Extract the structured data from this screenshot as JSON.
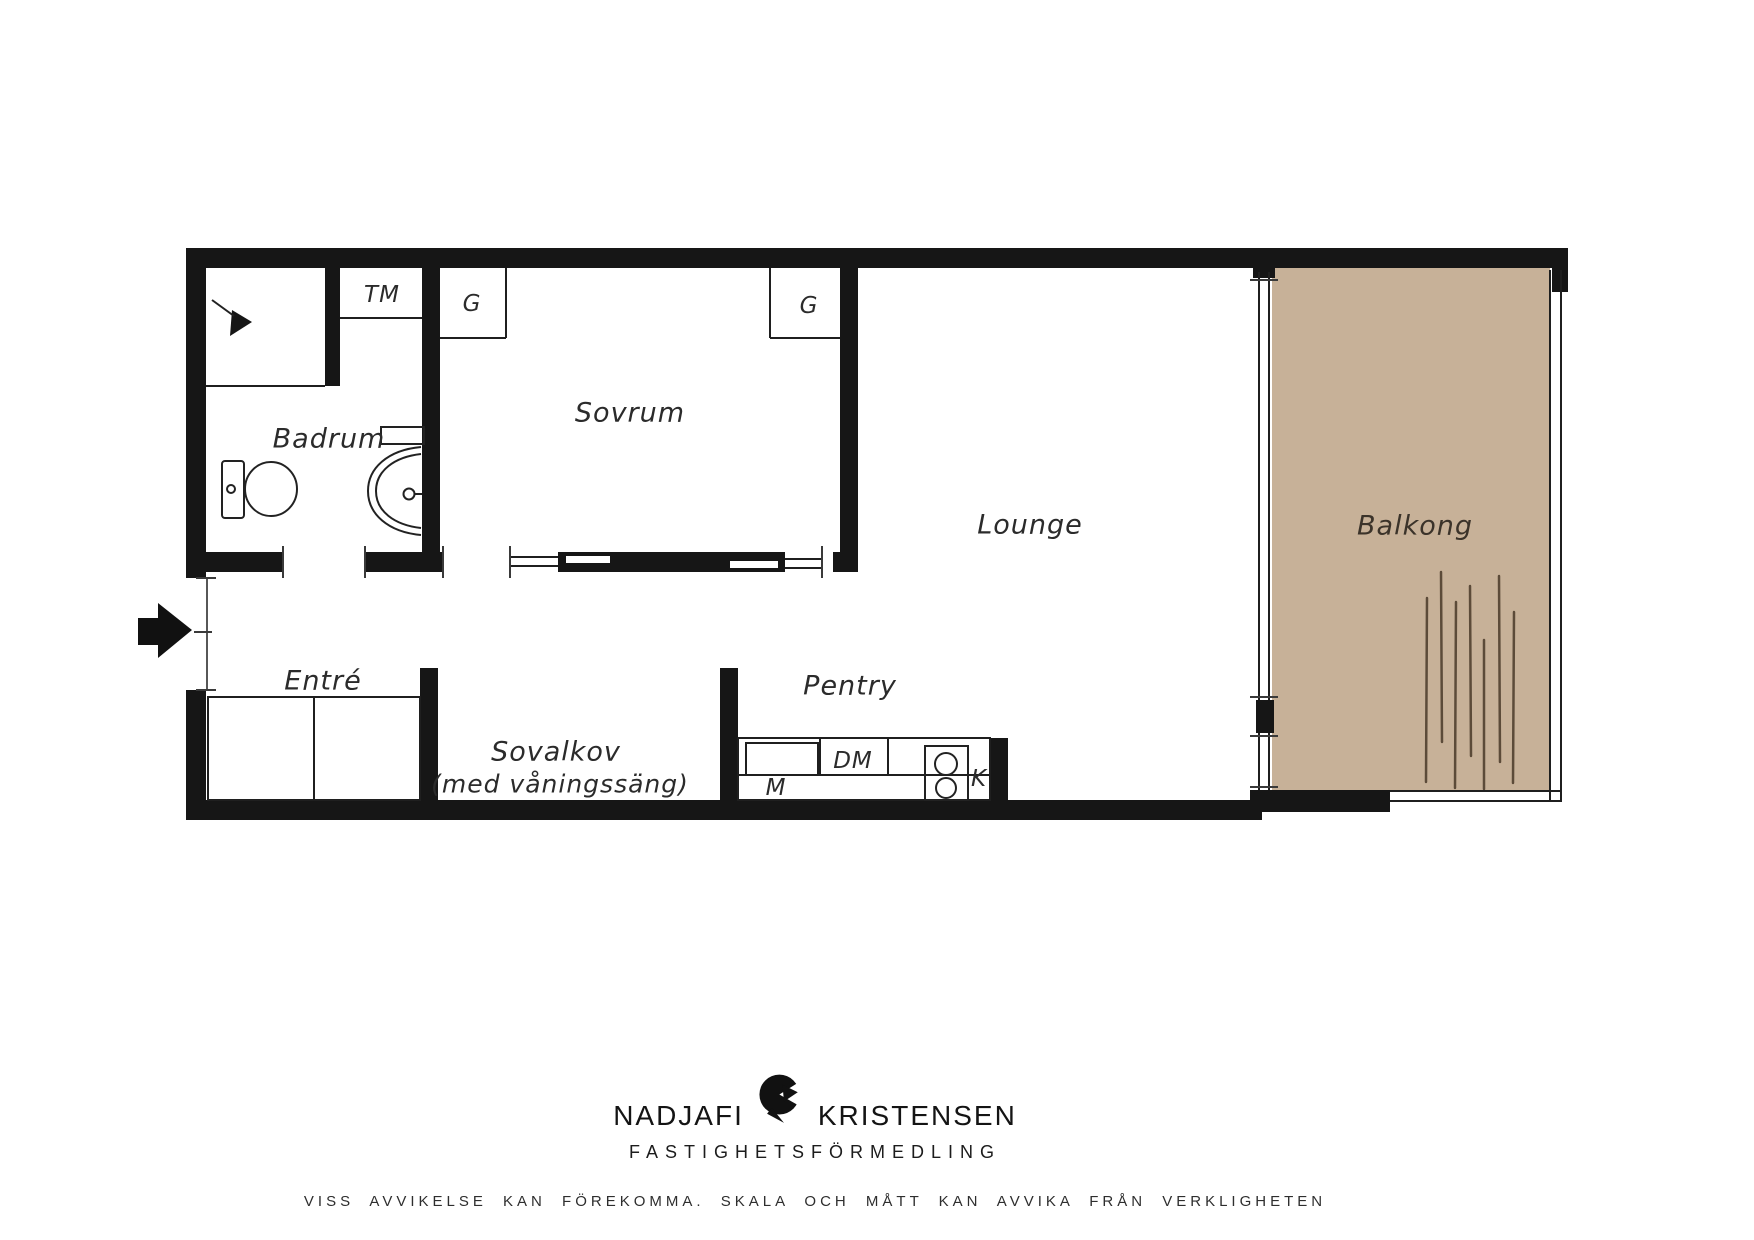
{
  "floorplan": {
    "labels": {
      "tm": "TM",
      "g1": "G",
      "g2": "G",
      "sovrum": "Sovrum",
      "badrum": "Badrum",
      "lounge": "Lounge",
      "balkong": "Balkong",
      "entre": "Entré",
      "sovalkov": "Sovalkov",
      "sovalkov_sub": "(med våningssäng)",
      "pentry": "Pentry",
      "dm": "DM",
      "m": "M",
      "k": "K"
    },
    "icons": {
      "entrance-arrow-icon": "solid black arrow pointing right at entry door",
      "shower-icon": "shower head symbol in bathroom corner",
      "toilet-icon": "toilet plan symbol",
      "sink-icon": "washbasin plan symbol with faucet",
      "stove-icon": "two-burner cooktop symbol",
      "brand-logo-icon": "black crescent bird mark between brand words"
    },
    "colors": {
      "wall": "#161616",
      "balcony_floor": "#c7b198",
      "deck_line": "#5c4b39"
    }
  },
  "footer": {
    "brand_left": "NADJAFI",
    "brand_right": "KRISTENSEN",
    "brand_sub": "FASTIGHETSFÖRMEDLING",
    "disclaimer": "VISS AVVIKELSE KAN FÖREKOMMA. SKALA OCH MÅTT KAN AVVIKA FRÅN VERKLIGHETEN"
  }
}
